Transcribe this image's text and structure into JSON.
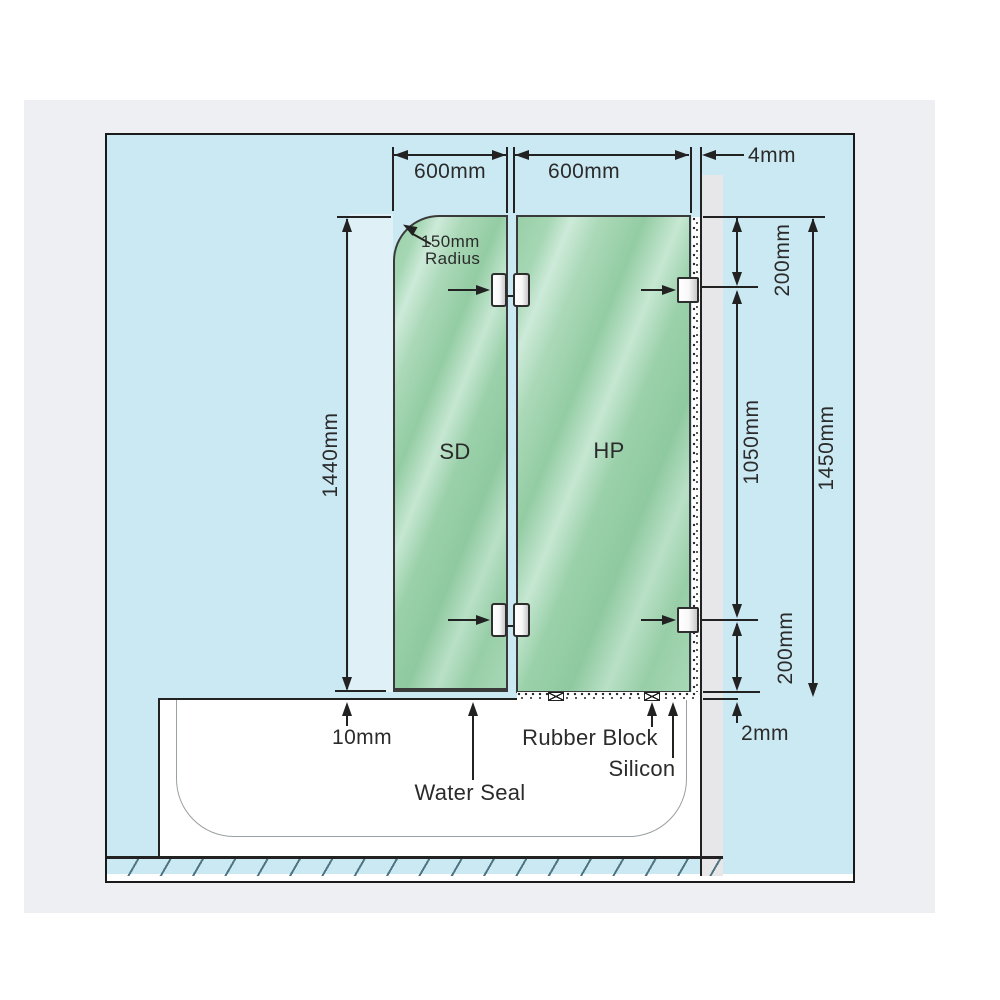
{
  "title": "Frameless bath shower screen installation diagram",
  "colors": {
    "page_bg": "#ffffff",
    "photo_bg": "#edeff2",
    "diagram_bg": "#cbe9f2",
    "frame_border": "#1a1a1a",
    "glass_green": "#9bd1aa",
    "wall_gray": "#e7e7e9",
    "line_color": "#222222",
    "hatch_color": "#4f7482"
  },
  "dimensions": {
    "top_left_panel_width": "600mm",
    "top_right_panel_width": "600mm",
    "wall_gap": "4mm",
    "corner_radius_line1": "150mm",
    "corner_radius_line2": "Radius",
    "screen_height": "1440mm",
    "bracket_top_offset": "200mm",
    "bracket_spacing": "1050mm",
    "wall_height": "1450mm",
    "bracket_bottom_offset": "200mm",
    "bottom_gap": "10mm",
    "silicon_gap": "2mm"
  },
  "panels": {
    "left_label": "SD",
    "right_label": "HP"
  },
  "annotations": {
    "water_seal": "Water Seal",
    "rubber_block": "Rubber Block",
    "silicon": "Silicon"
  }
}
